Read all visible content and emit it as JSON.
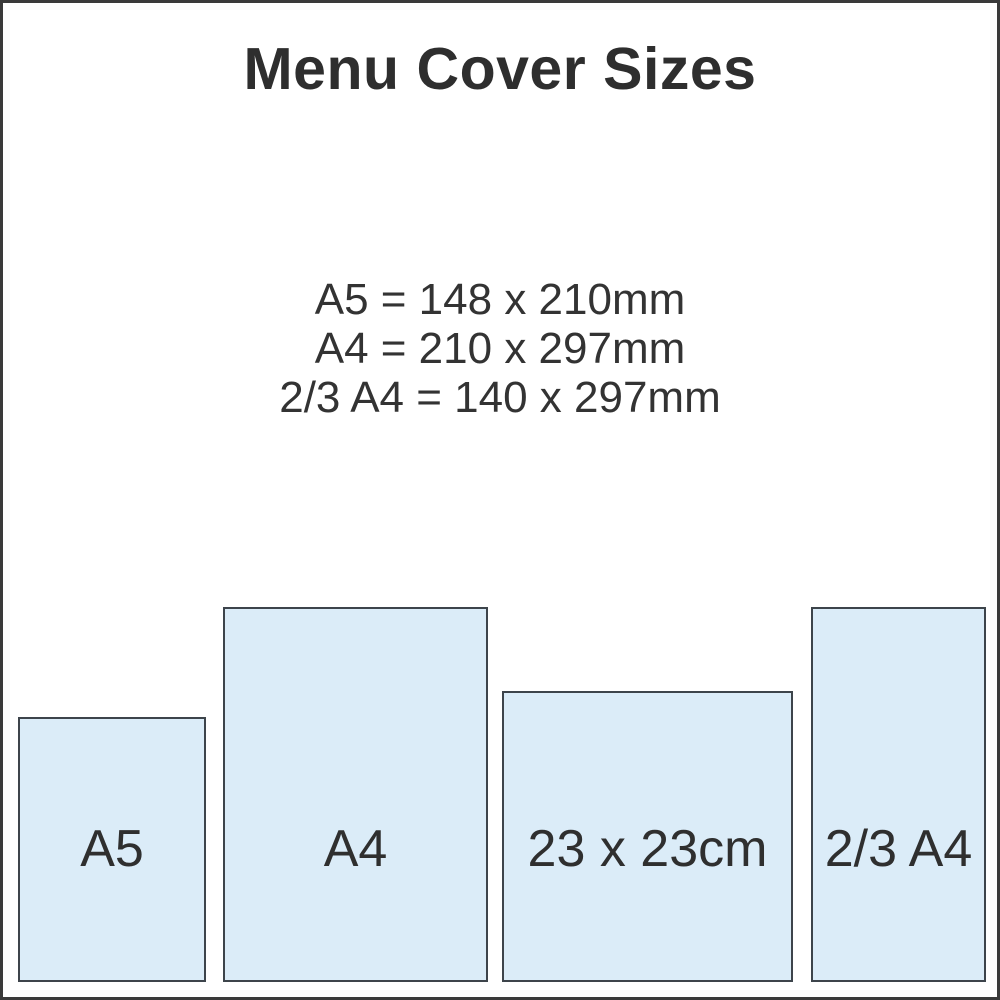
{
  "title": "Menu Cover Sizes",
  "specs": {
    "lines": [
      "A5 = 148 x 210mm",
      "A4 = 210 x 297mm",
      "2/3 A4 = 140 x 297mm"
    ]
  },
  "sizes": [
    {
      "label": "A5"
    },
    {
      "label": "A4"
    },
    {
      "label": "23 x 23cm"
    },
    {
      "label": "2/3 A4"
    }
  ],
  "colors": {
    "background": "#ffffff",
    "frame_border": "#3a3a3a",
    "panel_fill": "#dbecf8",
    "panel_border": "#3d444b",
    "text": "#333333"
  }
}
